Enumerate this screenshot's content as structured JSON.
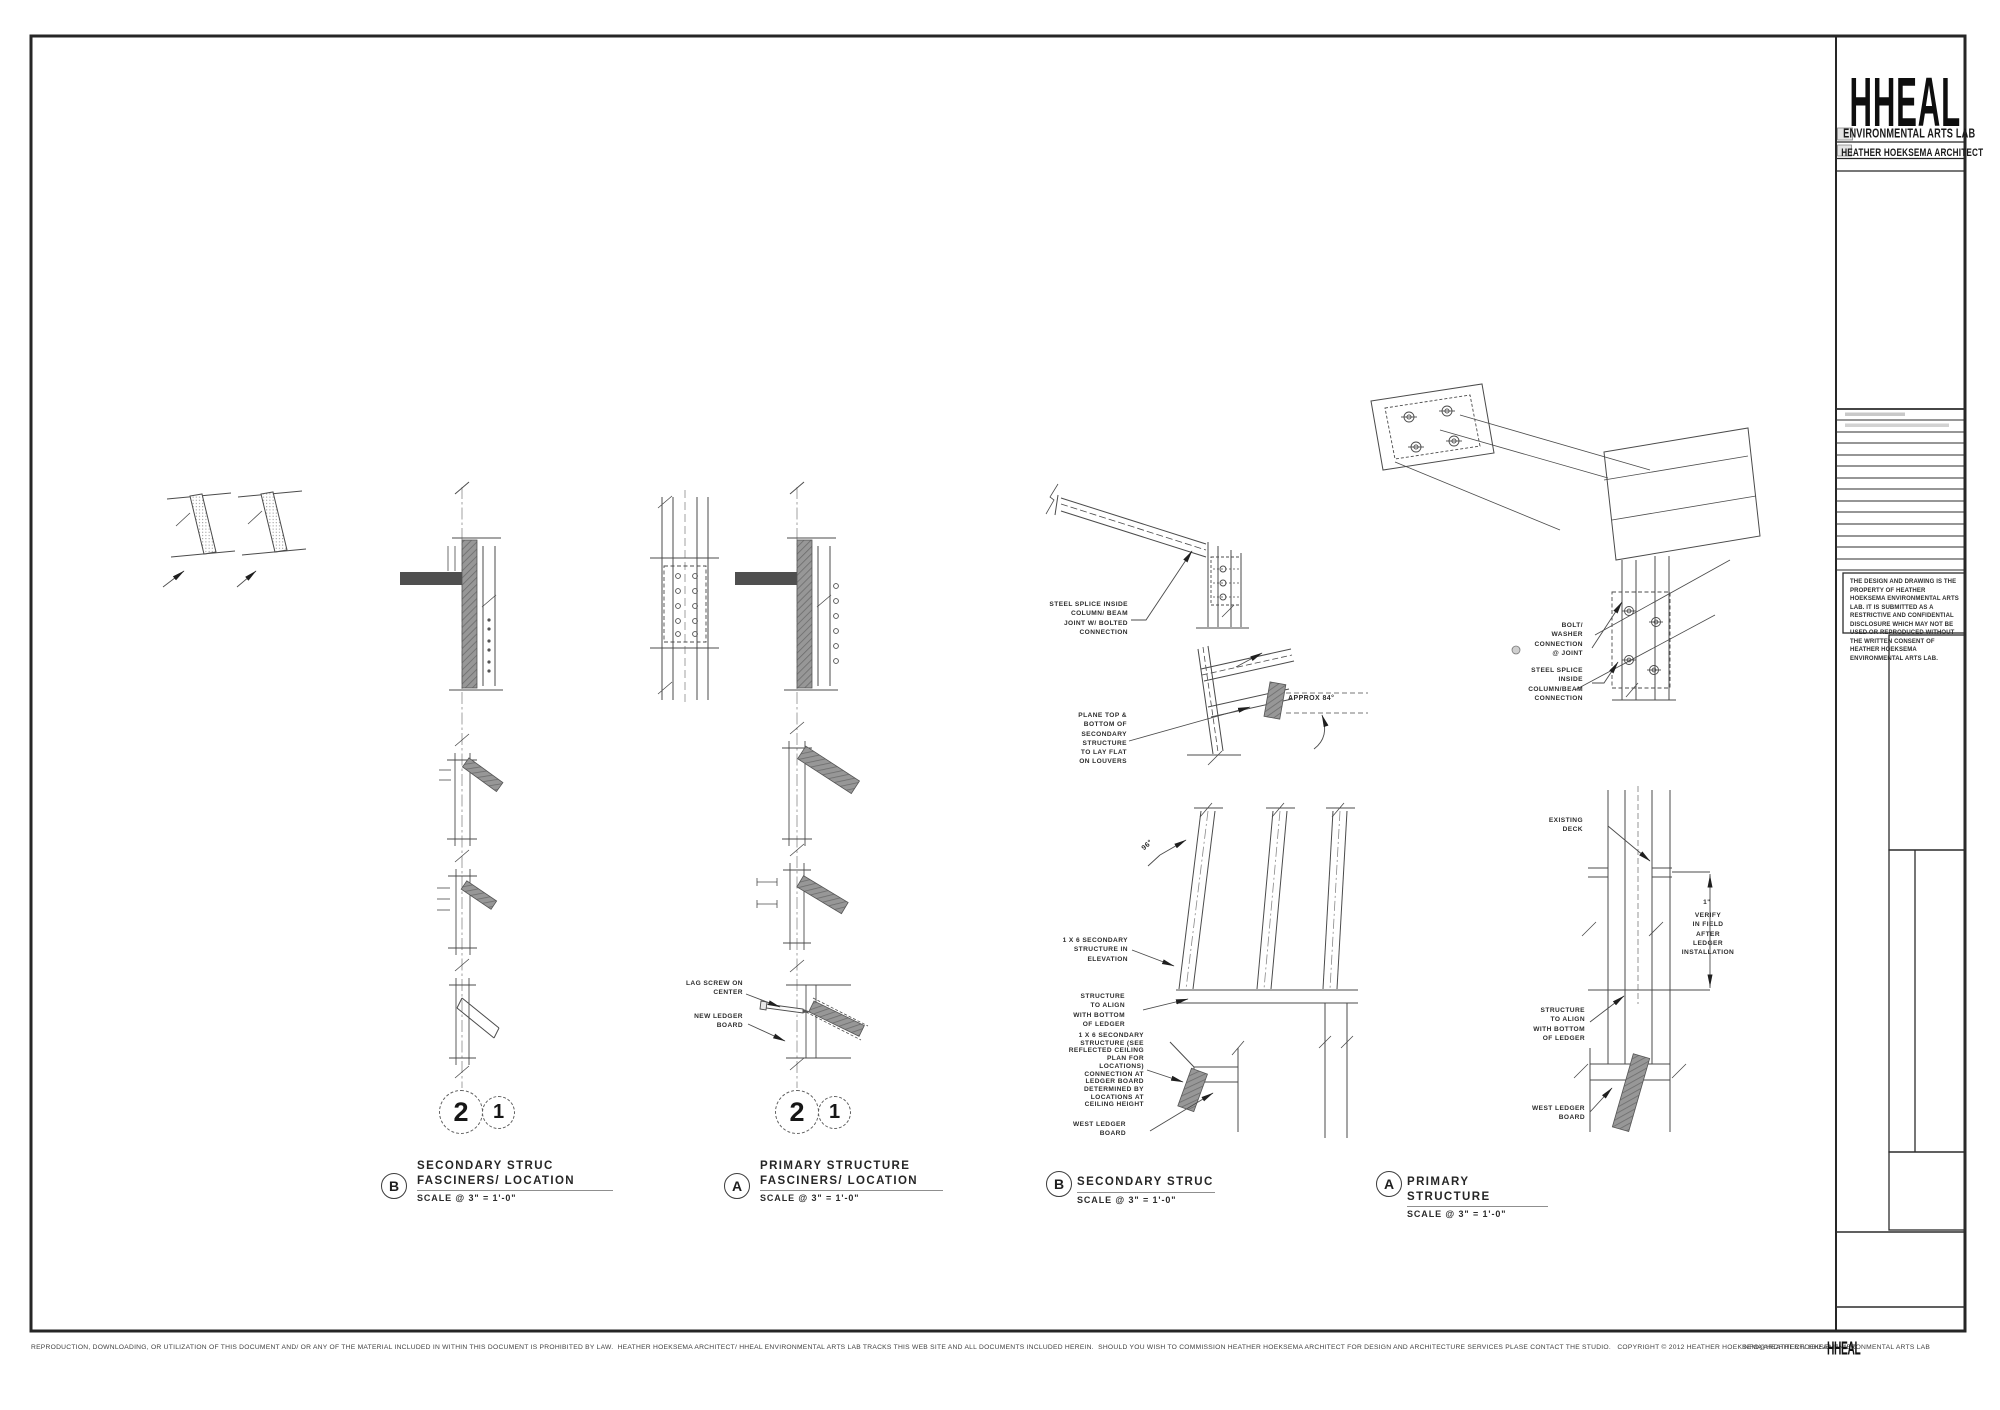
{
  "details": {
    "b1": {
      "letter": "B",
      "line1": "SECONDARY STRUC",
      "line2": "FASCINERS/ LOCATION",
      "scale": "SCALE @ 3\" = 1'-0\""
    },
    "a1": {
      "letter": "A",
      "line1": "PRIMARY STRUCTURE",
      "line2": "FASCINERS/ LOCATION",
      "scale": "SCALE @ 3\" = 1'-0\""
    },
    "b2": {
      "letter": "B",
      "line1": "SECONDARY STRUC",
      "scale": "SCALE @ 3\" = 1'-0\""
    },
    "a2": {
      "letter": "A",
      "line1": "PRIMARY STRUCTURE",
      "scale": "SCALE @ 3\" = 1'-0\""
    }
  },
  "bubbles": {
    "two": "2",
    "one": "1"
  },
  "annotations": {
    "b2_steel_splice": "STEEL SPLICE INSIDE\nCOLUMN/ BEAM\nJOINT W/ BOLTED\nCONNECTION",
    "b2_plane_top": "PLANE TOP &\nBOTTOM OF\nSECONDARY\nSTRUCTURE\nTO LAY FLAT\nON LOUVERS",
    "b2_approx84": "APPROX 84°",
    "b2_deg96": "96°",
    "b2_elevation": "1 X 6 SECONDARY\nSTRUCTURE IN\nELEVATION",
    "b2_align": "STRUCTURE\nTO ALIGN\nWITH BOTTOM\nOF LEDGER",
    "b2_ceiling": "1 X 6 SECONDARY\nSTRUCTURE (SEE\nREFLECTED CEILING\nPLAN FOR\nLOCATIONS)\nCONNECTION AT\nLEDGER BOARD\nDETERMINED BY\nLOCATIONS AT\nCEILING HEIGHT",
    "b2_west_ledger": "WEST LEDGER\nBOARD",
    "a2_bolt_washer": "BOLT/\nWASHER\nCONNECTION\n@ JOINT",
    "a2_steel_splice": "STEEL SPLICE\nINSIDE\nCOLUMN/BEAM\nCONNECTION",
    "a2_existing_deck": "EXISTING\nDECK",
    "a2_one_inch": "1\"",
    "a2_verify": "VERIFY\nIN FIELD\nAFTER\nLEDGER\nINSTALLATION",
    "a2_align": "STRUCTURE\nTO ALIGN\nWITH BOTTOM\nOF LEDGER",
    "a2_west_ledger": "WEST LEDGER\nBOARD",
    "a1_lag_screw": "LAG SCREW ON\nCENTER",
    "a1_new_ledger": "NEW LEDGER\nBOARD"
  },
  "titleblock": {
    "logo": "HHEAL",
    "studio": "ENVIRONMENTAL ARTS LAB",
    "architect": "HEATHER HOEKSEMA ARCHITECT",
    "disclaimer": "THE DESIGN AND DRAWING IS THE PROPERTY OF HEATHER HOEKSEMA ENVIRONMENTAL ARTS LAB.  IT IS SUBMITTED AS A RESTRICTIVE AND CONFIDENTIAL DISCLOSURE WHICH MAY NOT BE USED OR REPRODUCED WITHOUT THE WRITTEN CONSENT OF HEATHER HOEKSEMA ENVIRONMENTAL ARTS LAB."
  },
  "footer": {
    "legal": "REPRODUCTION, DOWNLOADING, OR UTILIZATION OF THIS DOCUMENT AND/ OR ANY OF THE MATERIAL INCLUDED IN WITHIN THIS DOCUMENT IS PROHIBITED BY LAW.  HEATHER HOEKSEMA ARCHITECT/ HHEAL ENVIRONMENTAL ARTS LAB TRACKS THIS WEB SITE AND ALL DOCUMENTS INCLUDED HEREIN.  SHOULD YOU WISH TO COMMISSION HEATHER HOEKSEMA ARCHITECT FOR DESIGN AND ARCHITECTURE SERVICES PLASE CONTACT THE STUDIO.   COPYRIGHT © 2012 HEATHER HOEKSEMA ARCHITECT/ HHEAL ENVIRONMENTAL ARTS LAB",
    "email": "INFO@HEATHERHOEKSEMA.NET",
    "logo": "HHEAL"
  }
}
